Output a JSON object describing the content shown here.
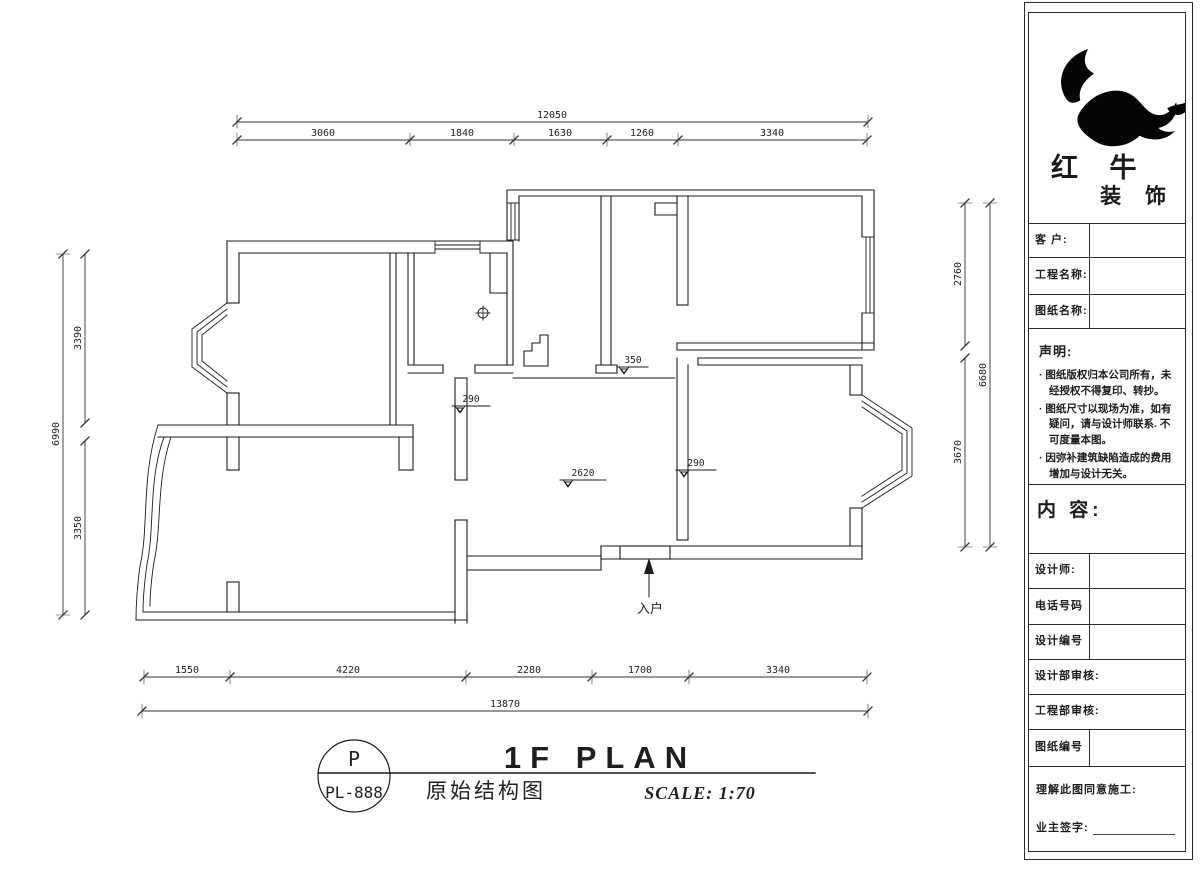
{
  "company": {
    "name1": "红 牛",
    "name2": "装 饰"
  },
  "title_block": {
    "customer_label": "客  户:",
    "project_label": "工程名称:",
    "drawing_label": "图纸名称:",
    "statement_title": "声明:",
    "statement_items": [
      "图纸版权归本公司所有，未经授权不得复印、转抄。",
      "图纸尺寸以现场为准，如有疑问，请与设计师联系. 不可度量本图。",
      "因弥补建筑缺陷造成的费用增加与设计无关。"
    ],
    "content_label": "内 容:",
    "designer_label": "设计师:",
    "phone_label": "电话号码",
    "design_no_label": "设计编号",
    "design_audit_label": "设计部审核:",
    "eng_audit_label": "工程部审核:",
    "drawing_no_label": "图纸编号",
    "agreement_label": "理解此图同意施工:",
    "sign_label": "业主签字:"
  },
  "titlebar": {
    "badge_letter": "P",
    "badge_code": "PL-888",
    "title": "1F PLAN",
    "subtitle": "原始结构图",
    "scale": "SCALE: 1:70"
  },
  "plan": {
    "entry_label": "入户",
    "level_marks": [
      {
        "value": "350"
      },
      {
        "value": "290"
      },
      {
        "value": "2620"
      },
      {
        "value": "290"
      }
    ]
  },
  "dimensions": {
    "top": {
      "overall": "12050",
      "segments": [
        "3060",
        "1840",
        "1630",
        "1260",
        "3340"
      ]
    },
    "bottom": {
      "overall": "13870",
      "segments": [
        "1550",
        "4220",
        "2280",
        "1700",
        "3340"
      ]
    },
    "left": {
      "overall": "6990",
      "segments": [
        "3390",
        "3350"
      ]
    },
    "right": {
      "overall": "6680",
      "segments": [
        "2760",
        "3670"
      ]
    }
  }
}
